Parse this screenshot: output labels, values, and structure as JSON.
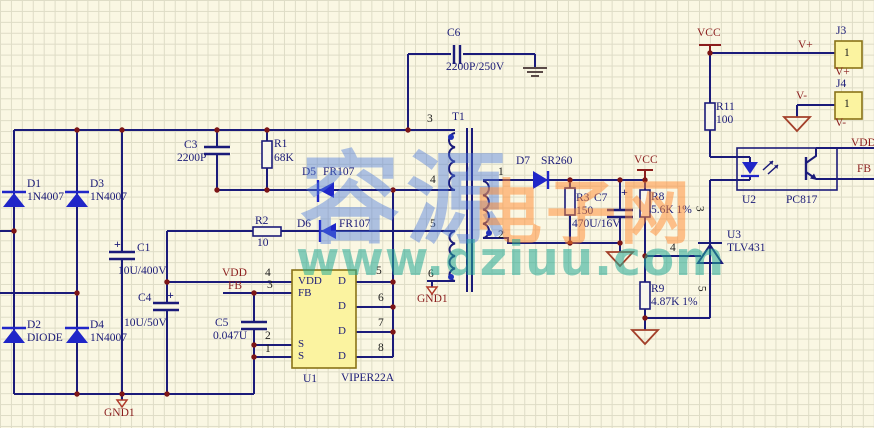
{
  "watermark": {
    "brand_cn": "容源",
    "site_cn": "电子网",
    "url": "www.dziuu.com"
  },
  "nets": {
    "vcc": "VCC",
    "vdd": "VDD",
    "fb": "FB",
    "gnd1": "GND1",
    "vplus": "V+",
    "vminus": "V-"
  },
  "components": {
    "d1": {
      "ref": "D1",
      "value": "1N4007"
    },
    "d2": {
      "ref": "D2",
      "value": "DIODE"
    },
    "d3": {
      "ref": "D3",
      "value": "1N4007"
    },
    "d4": {
      "ref": "D4",
      "value": "1N4007"
    },
    "d5": {
      "ref": "D5",
      "value": "FR107"
    },
    "d6": {
      "ref": "D6",
      "value": "FR107"
    },
    "d7": {
      "ref": "D7",
      "value": "SR260"
    },
    "c1": {
      "ref": "C1",
      "value": "10U/400V",
      "polarity": "+"
    },
    "c3": {
      "ref": "C3",
      "value": "2200P"
    },
    "c4": {
      "ref": "C4",
      "value": "10U/50V",
      "polarity": "+"
    },
    "c5": {
      "ref": "C5",
      "value": "0.047U"
    },
    "c6": {
      "ref": "C6",
      "value": "2200P/250V"
    },
    "c7": {
      "ref": "C7",
      "value": "470U/16V",
      "polarity": "+"
    },
    "r1": {
      "ref": "R1",
      "value": "68K"
    },
    "r2": {
      "ref": "R2",
      "value": "10"
    },
    "r3": {
      "ref": "R3",
      "value": "150"
    },
    "r8": {
      "ref": "R8",
      "value": "5.6K 1%"
    },
    "r9": {
      "ref": "R9",
      "value": "4.87K 1%"
    },
    "r11": {
      "ref": "R11",
      "value": "100"
    },
    "t1": {
      "ref": "T1",
      "pins_primary": [
        "3",
        "4",
        "5",
        "6"
      ],
      "pins_secondary": [
        "1",
        "2"
      ]
    },
    "u1": {
      "ref": "U1",
      "value": "VIPER22A",
      "left_pin_numbers": [
        "4",
        "3",
        "2",
        "1"
      ],
      "right_pin_numbers": [
        "5",
        "6",
        "7",
        "8"
      ],
      "left_pin_names": [
        "VDD",
        "FB",
        "S",
        "S"
      ],
      "right_pin_names": [
        "D",
        "D",
        "D",
        "D"
      ]
    },
    "u2": {
      "ref": "U2",
      "value": "PC817"
    },
    "u3": {
      "ref": "U3",
      "value": "TLV431",
      "pin_numbers": [
        "3",
        "4",
        "5"
      ]
    },
    "j3": {
      "ref": "J3",
      "pin": "1",
      "net": "V+"
    },
    "j4": {
      "ref": "J4",
      "pin": "1",
      "net": "V-"
    }
  }
}
